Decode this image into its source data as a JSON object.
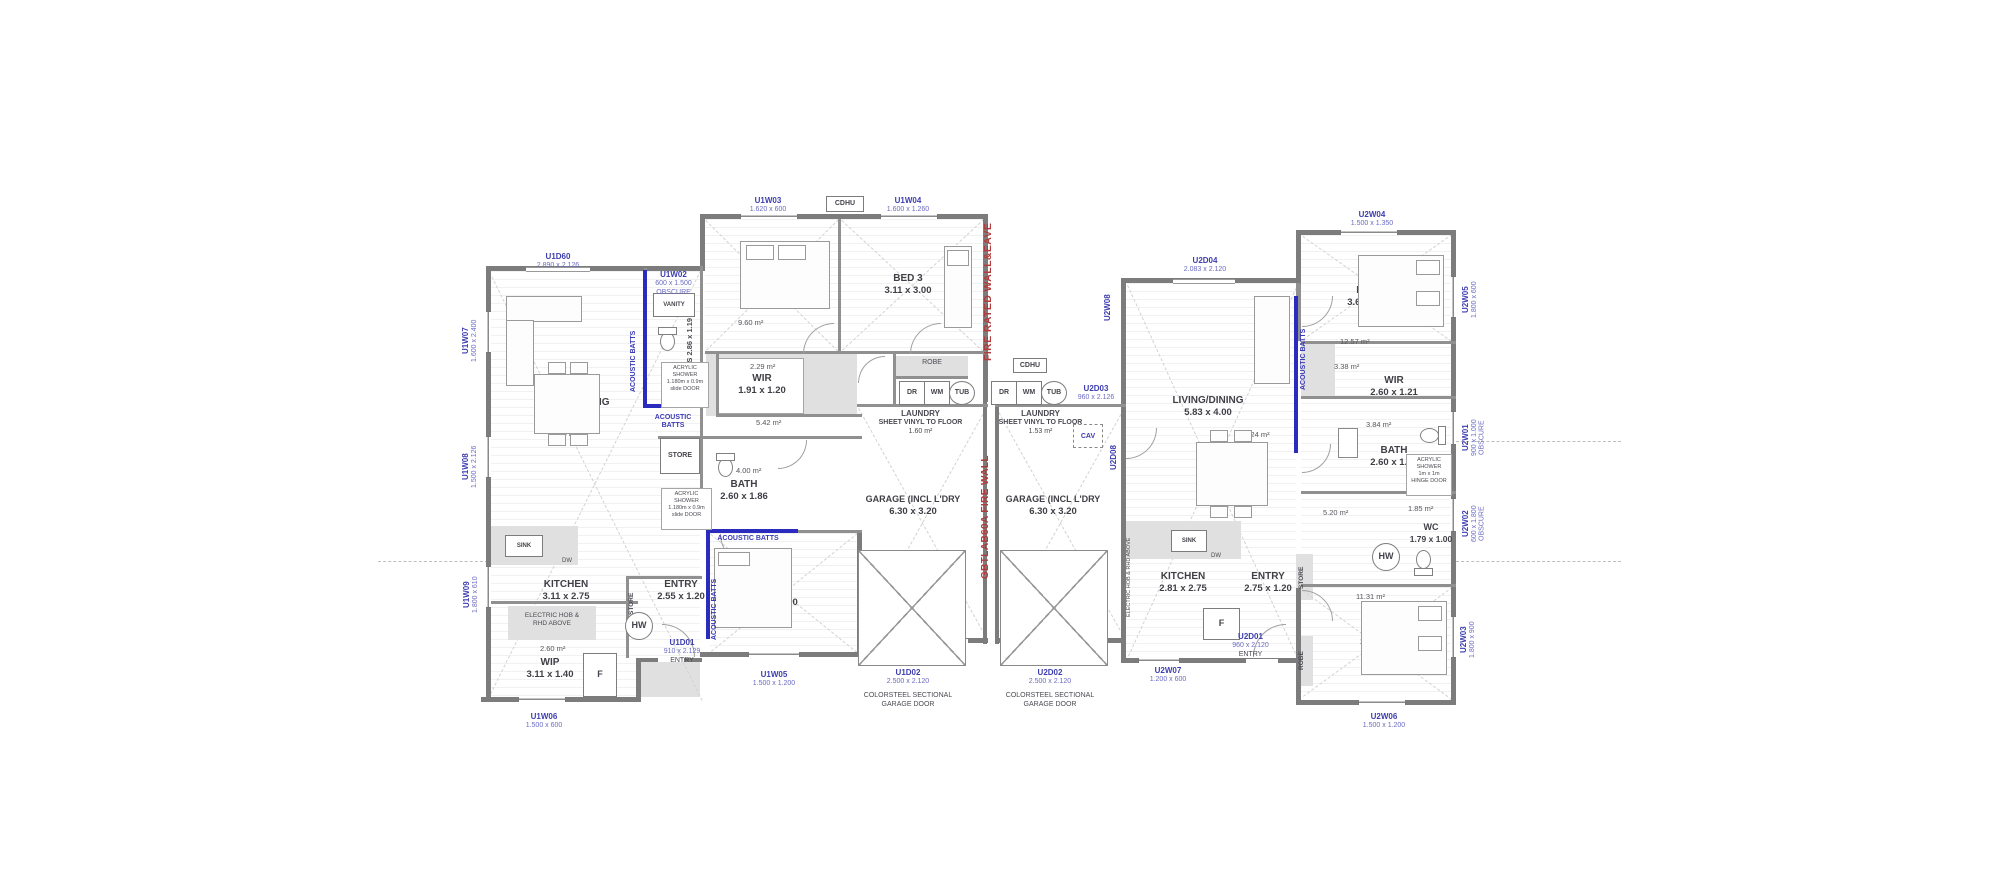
{
  "labels": {
    "fire_eave": "FIRE RATED WALL&EAVE",
    "fire_wall": "GBTLAB60A FIRE WALL",
    "acoustic": "ACOUSTIC BATTS",
    "acoustic_l1": "ACOUSTIC",
    "acoustic_l2": "BATTS",
    "colorsteel_l1": "COLORSTEEL SECTIONAL",
    "colorsteel_l2": "GARAGE DOOR"
  },
  "fixtures": {
    "hw": "HW",
    "fridge": "F",
    "dr": "DR",
    "wm": "WM",
    "tub": "TUB",
    "sink": "SINK",
    "dw": "DW",
    "store": "STORE",
    "robe": "ROBE",
    "cav": "CAV",
    "cdhu": "CDHU",
    "vanity": "VANITY"
  },
  "unit1": {
    "living": {
      "name": "LIVING/DINING",
      "dims": "5.70 x 4.01",
      "area": "30.06 m²"
    },
    "kitchen": {
      "name": "KITCHEN",
      "dims": "3.11 x 2.75"
    },
    "wip": {
      "name": "WIP",
      "dims": "3.11 x 1.40",
      "area": "2.60 m²"
    },
    "entry": {
      "name": "ENTRY",
      "dims": "2.55 x 1.20"
    },
    "bed1": {
      "name": "BED 1",
      "dims": "3.20 x 3.00",
      "area": "9.60 m²"
    },
    "bed2": {
      "name": "BED 2",
      "dims": "3.10 x 3.00"
    },
    "bed3": {
      "name": "BED 3",
      "dims": "3.11 x 3.00"
    },
    "wir": {
      "name": "WIR",
      "dims": "1.91 x 1.20",
      "area": "2.29 m²"
    },
    "bath": {
      "name": "BATH",
      "dims": "2.60 x 1.86",
      "area": "4.00 m²"
    },
    "ens": {
      "label": "ENS 2.86 x 1.19"
    },
    "hall_area": "5.42 m²",
    "laundry": {
      "name": "LAUNDRY",
      "note": "SHEET VINYL TO FLOOR",
      "area": "1.60 m²"
    },
    "garage": {
      "name": "GARAGE (INCL L'DRY",
      "dims": "6.30 x 3.20"
    },
    "shower": {
      "l1": "ACRYLIC",
      "l2": "SHOWER",
      "l3": "1.180m x 0.9m",
      "l4": "slide DOOR"
    },
    "hob": {
      "l1": "ELECTRIC HOB &",
      "l2": "RHD ABOVE"
    }
  },
  "unit2": {
    "living": {
      "name": "LIVING/DINING",
      "dims": "5.83 x 4.00",
      "area": "31.24 m²"
    },
    "kitchen": {
      "name": "KITCHEN",
      "dims": "2.81 x 2.75"
    },
    "entry": {
      "name": "ENTRY",
      "dims": "2.75 x 1.20"
    },
    "bed1": {
      "name": "BED 1",
      "dims": "3.00 x 3.00",
      "area": "11.31 m²"
    },
    "bed2": {
      "name": "BED 2",
      "dims": "3.69 x 3.00",
      "area": "12.57 m²"
    },
    "wir": {
      "name": "WIR",
      "dims": "2.60 x 1.21",
      "area": "3.38 m²"
    },
    "bath": {
      "name": "BATH",
      "dims": "2.60 x 1.86",
      "area": "3.84 m²"
    },
    "wc": {
      "name": "WC",
      "dims": "1.79 x 1.00",
      "area": "1.85 m²"
    },
    "hall_area": "5.20 m²",
    "laundry": {
      "name": "LAUNDRY",
      "note": "SHEET VINYL TO FLOOR",
      "area": "1.53 m²"
    },
    "garage": {
      "name": "GARAGE (INCL L'DRY",
      "dims": "6.30 x 3.20"
    },
    "shower": {
      "l1": "ACRYLIC",
      "l2": "SHOWER",
      "l3": "1m x 1m",
      "l4": "HINGE DOOR"
    },
    "hob": "ELECTRIC HOB & RHD ABOVE"
  },
  "openings": {
    "u1d60": {
      "c": "U1D60",
      "s": "2.890 x 2.126"
    },
    "u1w02": {
      "c": "U1W02",
      "s": "600 x 1.500",
      "x": "OBSCURE"
    },
    "u1w03": {
      "c": "U1W03",
      "s": "1.620 x 600"
    },
    "u1w04": {
      "c": "U1W04",
      "s": "1.600 x 1.260"
    },
    "u1w05": {
      "c": "U1W05",
      "s": "1.500 x 1.200"
    },
    "u1w06": {
      "c": "U1W06",
      "s": "1.500 x 600"
    },
    "u1w07": {
      "c": "U1W07",
      "s": "1.600 x 2.400"
    },
    "u1w08": {
      "c": "U1W08",
      "s": "1.500 x 2.126"
    },
    "u1w09": {
      "c": "U1W09",
      "s": "1.800 x 610"
    },
    "u1d01": {
      "c": "U1D01",
      "s": "910 x 2.129",
      "x": "ENTRY"
    },
    "u1d02": {
      "c": "U1D02",
      "s": "2.500 x 2.120"
    },
    "u2d01": {
      "c": "U2D01",
      "s": "960 x 2.120",
      "x": "ENTRY"
    },
    "u2d02": {
      "c": "U2D02",
      "s": "2.500 x 2.120"
    },
    "u2d03": {
      "c": "U2D03",
      "s": "960 x 2.126"
    },
    "u2d04": {
      "c": "U2D04",
      "s": "2.083 x 2.120"
    },
    "u2w01": {
      "c": "U2W01",
      "s": "900 x 1.000",
      "x": "OBSCURE"
    },
    "u2w02": {
      "c": "U2W02",
      "s": "600 x 1.800",
      "x": "OBSCURE"
    },
    "u2w03": {
      "c": "U2W03",
      "s": "1.800 x 900"
    },
    "u2w04": {
      "c": "U2W04",
      "s": "1.500 x 1.350"
    },
    "u2w05": {
      "c": "U2W05",
      "s": "1.800 x 600"
    },
    "u2w06": {
      "c": "U2W06",
      "s": "1.500 x 1.200"
    },
    "u2w07": {
      "c": "U2W07",
      "s": "1.200 x 600"
    },
    "u2w08": {
      "c": "U2W08"
    },
    "u2d08": {
      "c": "U2D08"
    }
  }
}
